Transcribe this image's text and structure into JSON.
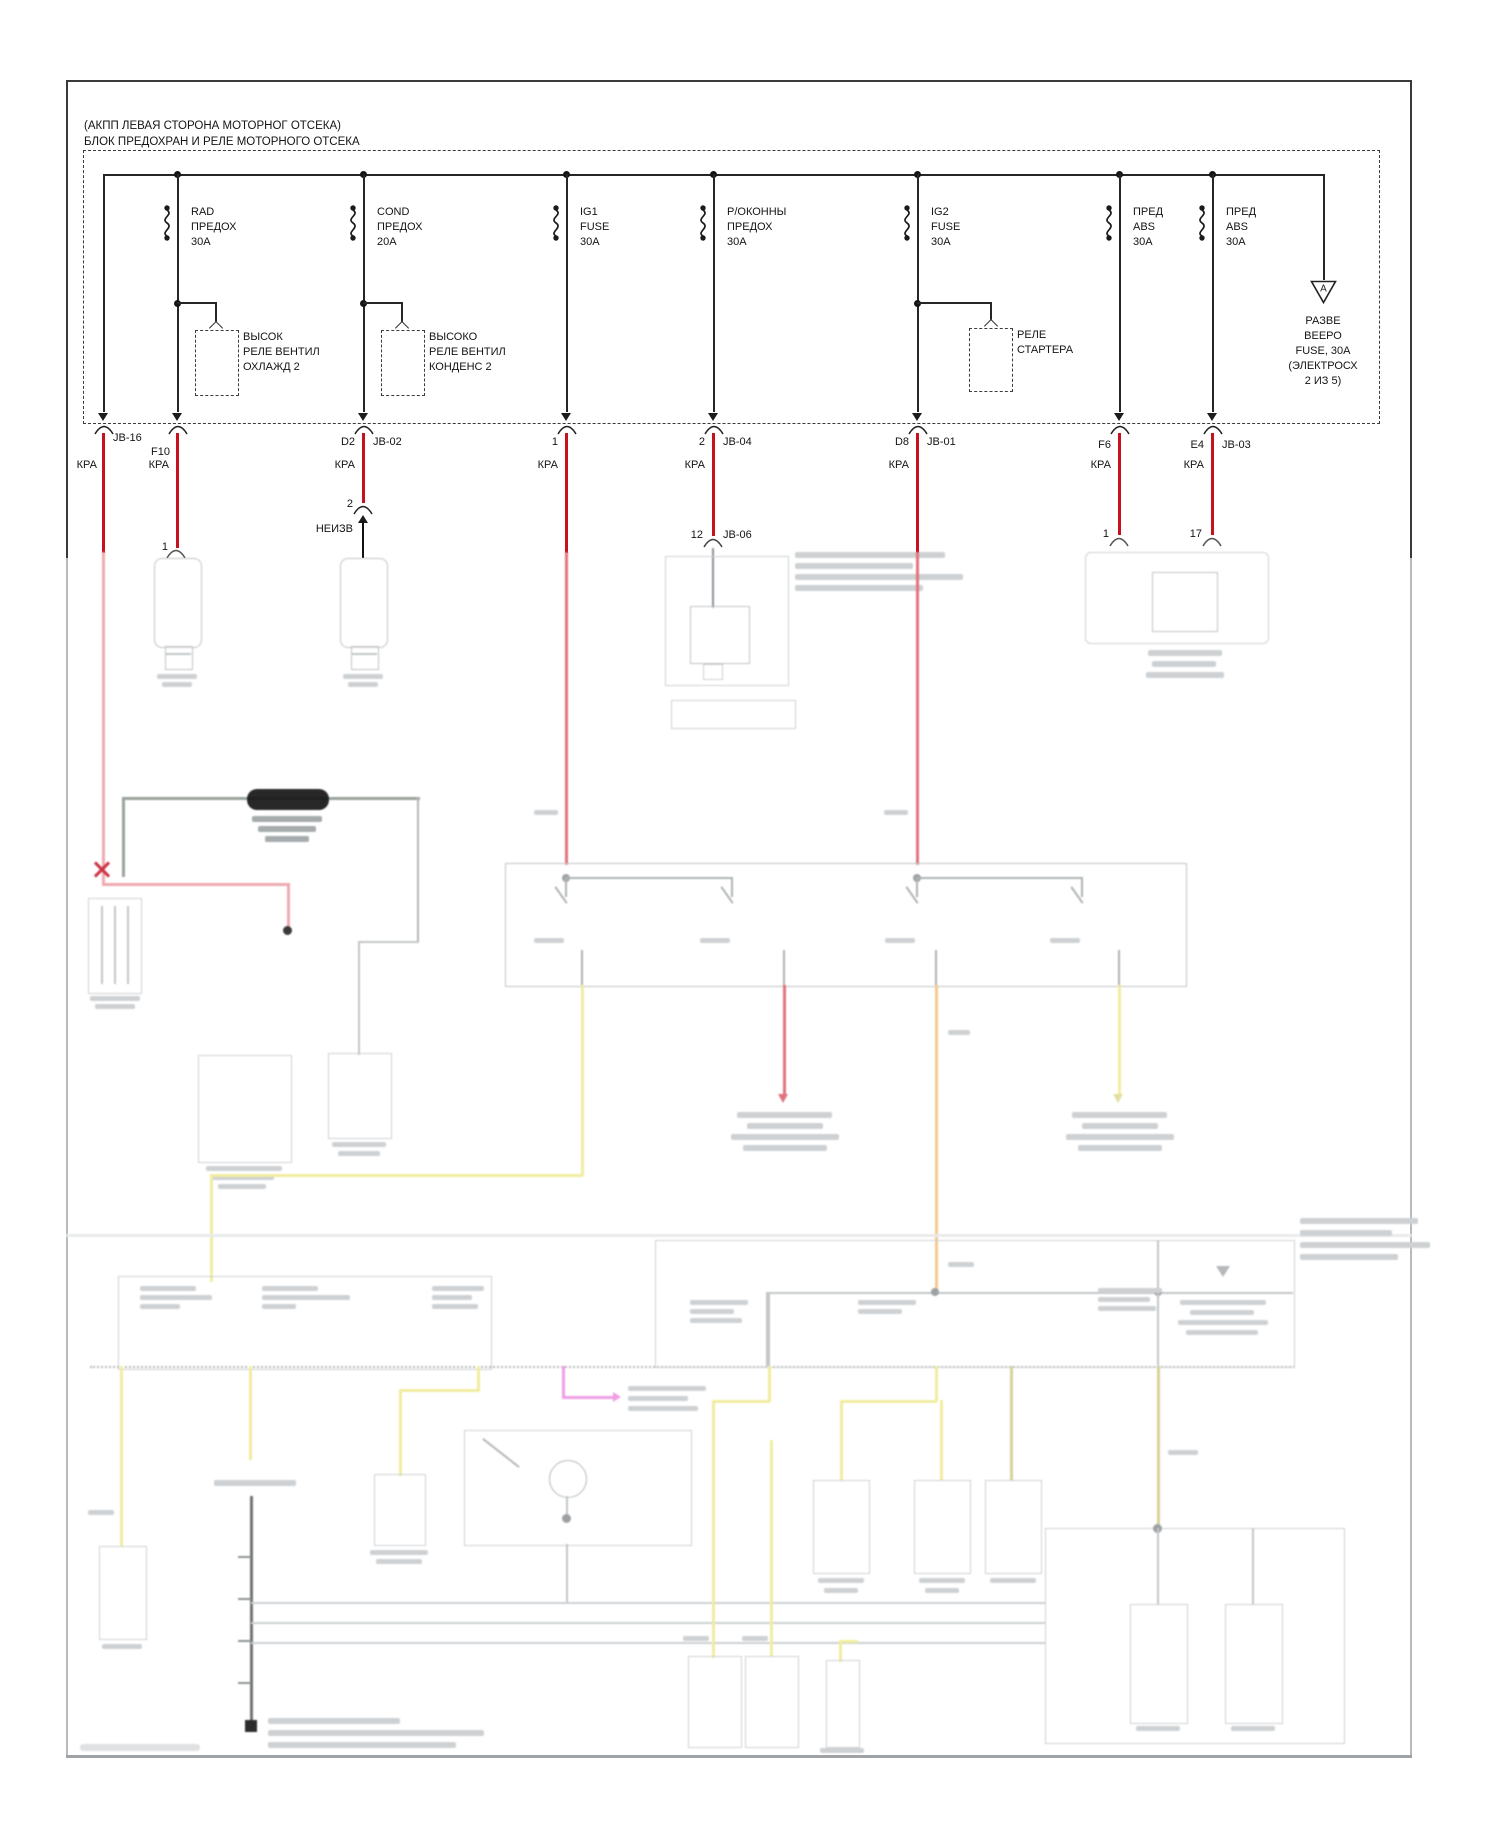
{
  "page": {
    "header_line1": "(АКПП ЛЕВАЯ СТОРОНА МОТОРНОГ ОТСЕКА)",
    "header_line2": "БЛОК ПРЕДОХРАН И РЕЛЕ МОТОРНОГО ОТСЕКА"
  },
  "wire_label": "КРА",
  "fuses": [
    {
      "l1": "RAD",
      "l2": "ПРЕДОХ",
      "l3": "30А"
    },
    {
      "l1": "COND",
      "l2": "ПРЕДОХ",
      "l3": "20А"
    },
    {
      "l1": "IG1",
      "l2": "FUSE",
      "l3": "30А"
    },
    {
      "l1": "Р/ОКОННЫ",
      "l2": "ПРЕДОХ",
      "l3": "30А"
    },
    {
      "l1": "IG2",
      "l2": "FUSE",
      "l3": "30А"
    },
    {
      "l1": "ПРЕД",
      "l2": "ABS",
      "l3": "30А"
    },
    {
      "l1": "ПРЕД",
      "l2": "ABS",
      "l3": "30А"
    }
  ],
  "relays": [
    {
      "l1": "ВЫСОК",
      "l2": "РЕЛЕ ВЕНТИЛ",
      "l3": "ОХЛАЖД 2"
    },
    {
      "l1": "ВЫСОКО",
      "l2": "РЕЛЕ ВЕНТИЛ",
      "l3": "КОНДЕНС 2"
    },
    {
      "l1": "РЕЛЕ",
      "l2": "СТАРТЕРА",
      "l3": ""
    }
  ],
  "spare_fuse": {
    "symbol": "A",
    "l1": "РАЗВЕ",
    "l2": "ВЕЕРО",
    "l3": "FUSE, 30A",
    "l4": "(ЭЛЕКТРОСХ",
    "l5": "2 ИЗ 5)"
  },
  "connector_row": {
    "jb16": "JB-16",
    "f10": "F10",
    "d2": "D2",
    "jb02": "JB-02",
    "ig1_pin": "1",
    "win_pin": "2",
    "jb04": "JB-04",
    "d8": "D8",
    "jb01": "JB-01",
    "f6": "F6",
    "e4": "E4",
    "jb03": "JB-03"
  },
  "lower_pins": {
    "f10_pin": "1",
    "d2_pin": "2",
    "d2_unknown": "НЕИЗВ",
    "jb06_pin": "12",
    "jb06": "JB-06",
    "f6_pin": "1",
    "e4_pin": "17"
  }
}
